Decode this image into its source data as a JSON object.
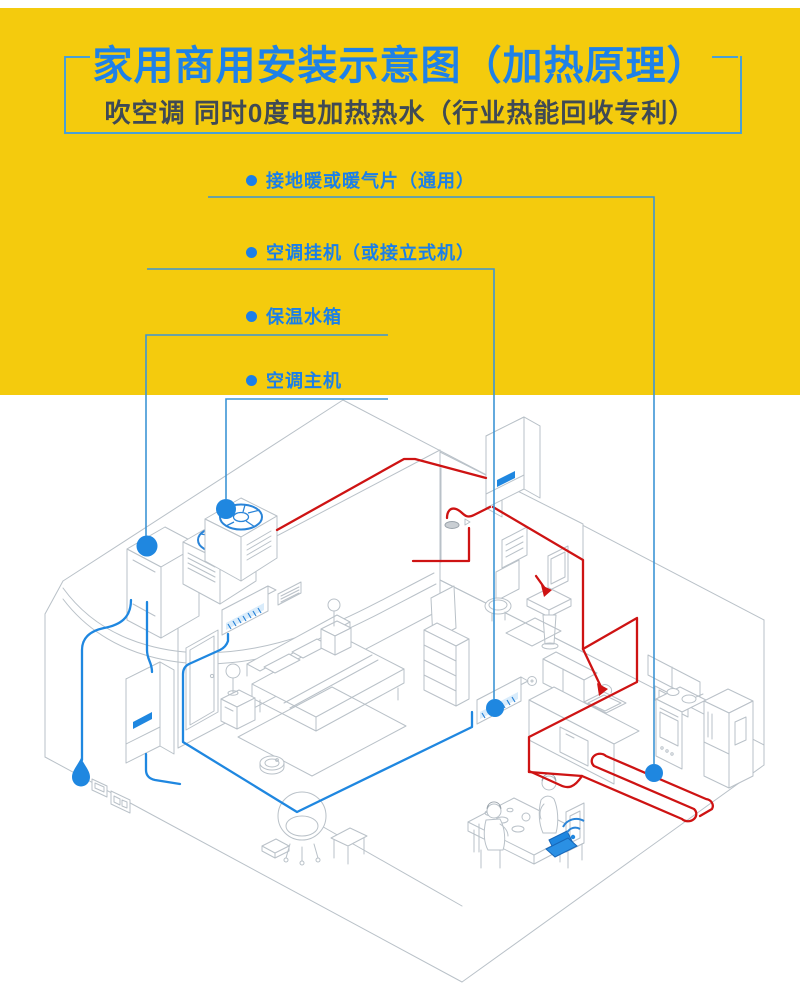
{
  "header": {
    "title": "家用商用安装示意图（加热原理）",
    "subtitle": "吹空调 同时0度电加热热水（行业热能回收专利）"
  },
  "callouts": [
    {
      "id": "floor-heating",
      "text": "接地暖或暖气片（通用）"
    },
    {
      "id": "indoor-ac-unit",
      "text": "空调挂机（或接立式机）"
    },
    {
      "id": "water-tank",
      "text": "保温水箱"
    },
    {
      "id": "outdoor-unit",
      "text": "空调主机"
    }
  ],
  "colors": {
    "background_yellow": "#F4CB0D",
    "title_blue": "#1E81E8",
    "subtitle_gray": "#3F4A55",
    "label_blue": "#1B7FE8",
    "leader_line_blue": "#3D95D5",
    "pipe_hot_red": "#CE1313",
    "pipe_cold_blue": "#1F87E0",
    "outline_gray": "#B9C1C8",
    "bracket_blue": "#4AA0D6"
  },
  "diagram": {
    "parts": [
      "outdoor-heat-pump-unit-icon",
      "insulated-water-tank-icon",
      "wall-hung-boiler-icon",
      "indoor-ac-bedroom-icon",
      "indoor-ac-dining-icon",
      "water-heater-box-icon",
      "floor-heating-coil-icon",
      "shower-icon",
      "toilet-icon",
      "sink-icon",
      "mirror-icon",
      "radiator-icon",
      "bed-icon",
      "nightstand-lamp-icon",
      "rug-icon",
      "robot-vacuum-icon",
      "tv-dresser-icon",
      "armchair-icon",
      "side-table-icon",
      "kitchen-cabinets-icon",
      "kitchen-sink-icon",
      "stove-oven-icon",
      "fridge-icon",
      "dining-table-icon",
      "person-standing-icon",
      "person-sitting-icon",
      "laptop-icon",
      "wifi-icon",
      "water-drop-icon",
      "wall-socket-icon"
    ]
  }
}
